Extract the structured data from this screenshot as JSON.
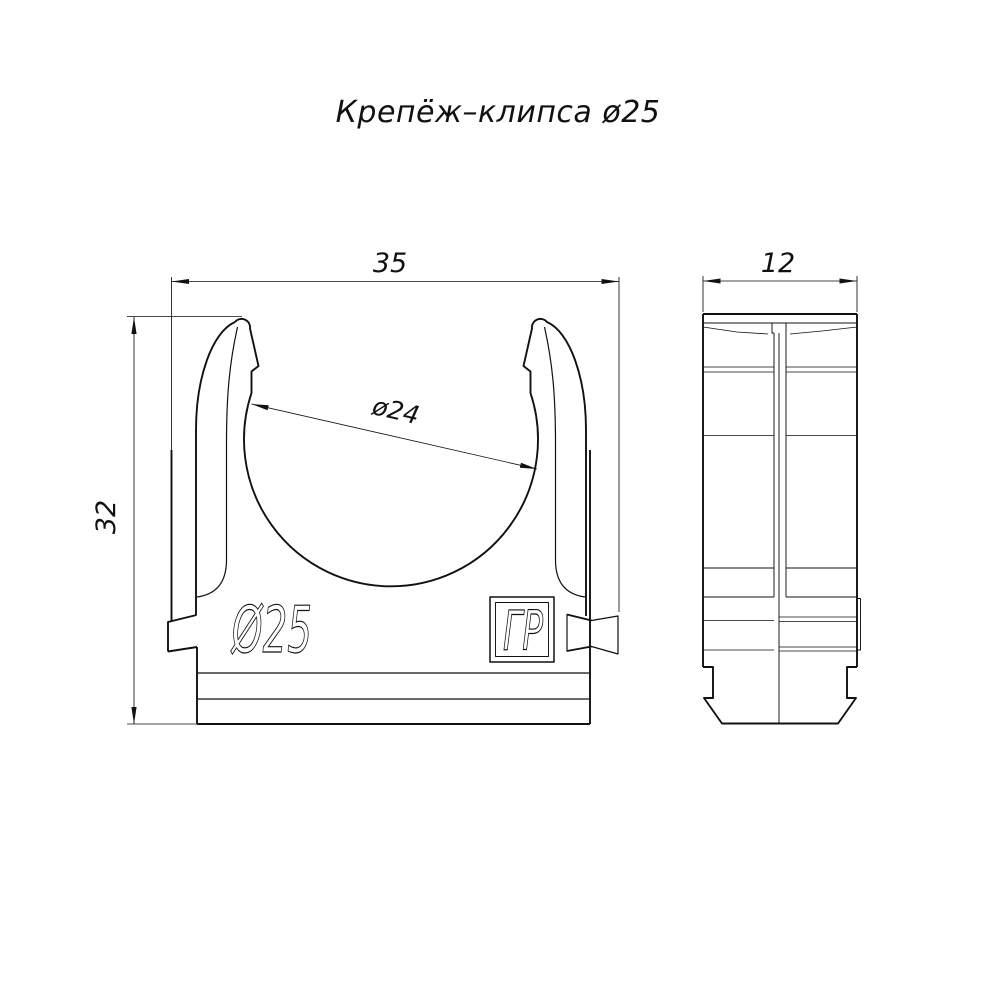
{
  "title": "Крепёж–клипса ø25",
  "front_view": {
    "width_dim": "35",
    "height_dim": "32",
    "inner_diameter_dim": "ø24",
    "embossed_text": "Ø25",
    "logo_text": "ГР"
  },
  "side_view": {
    "depth_dim": "12"
  },
  "colors": {
    "line_color": "#111111",
    "background": "#ffffff"
  }
}
